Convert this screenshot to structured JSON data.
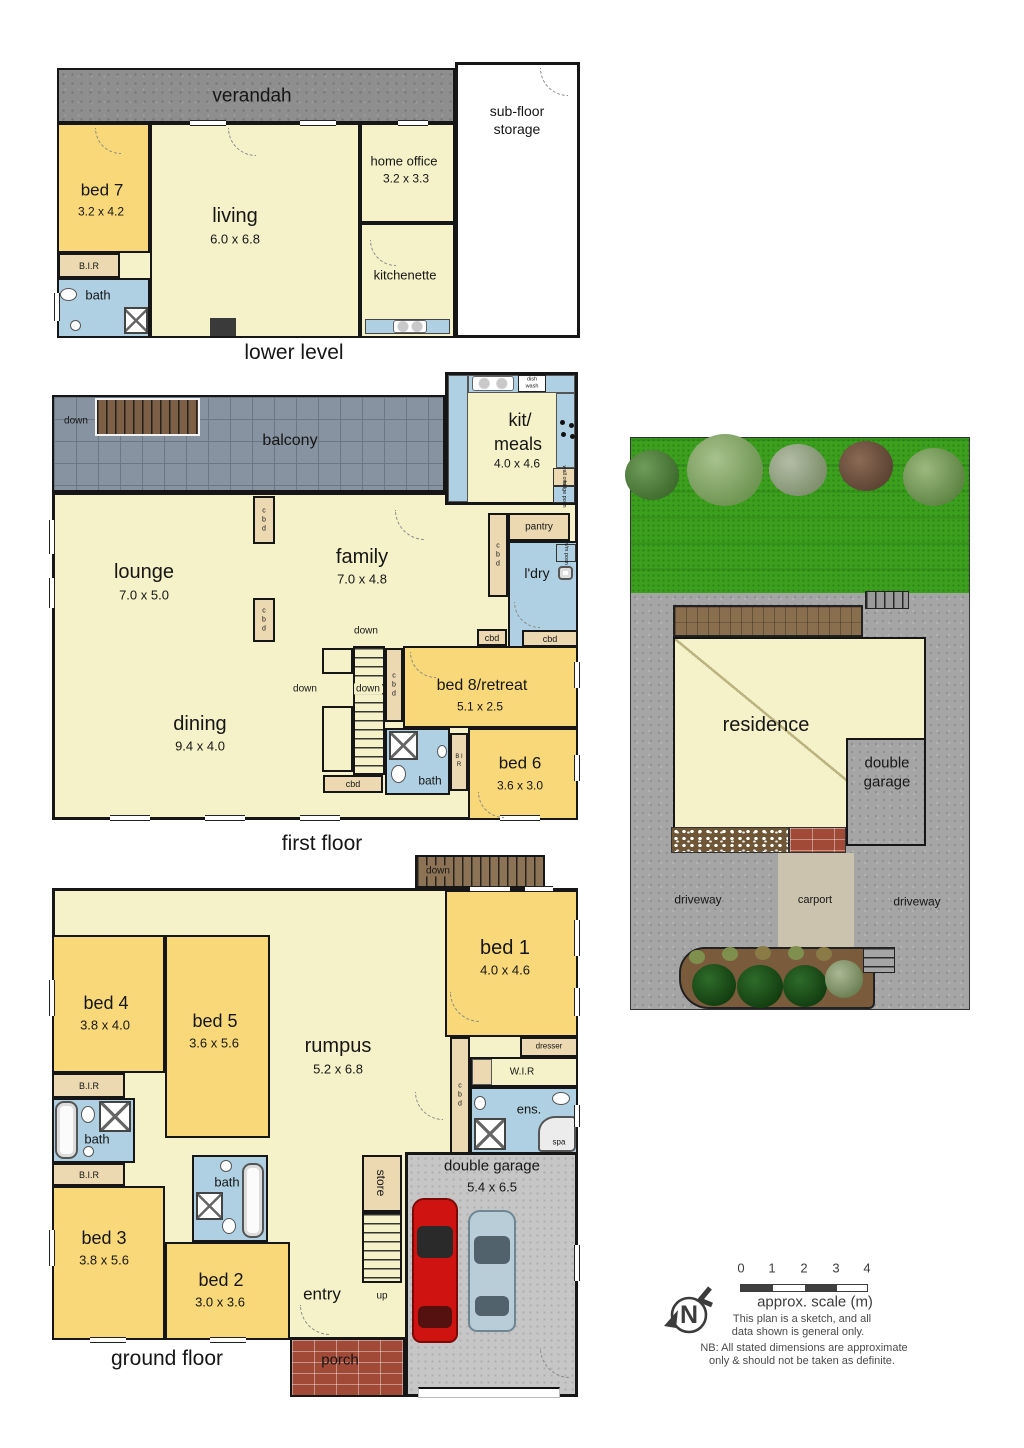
{
  "lower": {
    "title": "lower level",
    "verandah": "verandah",
    "subfloor1": "sub-floor",
    "subfloor2": "storage",
    "bed7": "bed 7",
    "bed7_dims": "3.2 x 4.2",
    "living": "living",
    "living_dims": "6.0 x 6.8",
    "office": "home office",
    "office_dims": "3.2 x 3.3",
    "kitchenette": "kitchenette",
    "bir": "B.I.R",
    "bath": "bath"
  },
  "first": {
    "title": "first floor",
    "balcony": "balcony",
    "down": "down",
    "kit1": "kit/",
    "kit2": "meals",
    "kit_dims": "4.0 x 4.6",
    "dishwash": "dish wash",
    "wall_oven": "wall oven",
    "fridge": "fridge posn",
    "pantry": "pantry",
    "ldry": "l'dry",
    "wm": "w/m posn",
    "lounge": "lounge",
    "lounge_dims": "7.0 x 5.0",
    "family": "family",
    "family_dims": "7.0 x 4.8",
    "dining": "dining",
    "dining_dims": "9.4 x 4.0",
    "bed8": "bed 8/retreat",
    "bed8_dims": "5.1 x 2.5",
    "bed6": "bed 6",
    "bed6_dims": "3.6 x 3.0",
    "bath": "bath",
    "cbd": "cbd",
    "cbd_v": "c b d",
    "bir_v": "B I R"
  },
  "site": {
    "residence": "residence",
    "garage1": "double",
    "garage2": "garage",
    "carport": "carport",
    "driveway": "driveway"
  },
  "ground": {
    "title": "ground floor",
    "balcony": "balcony",
    "up": "up",
    "down": "down",
    "bed1": "bed 1",
    "bed1_dims": "4.0 x 4.6",
    "bed4": "bed 4",
    "bed4_dims": "3.8 x 4.0",
    "bed5": "bed 5",
    "bed5_dims": "3.6 x 5.6",
    "rumpus": "rumpus",
    "rumpus_dims": "5.2 x 6.8",
    "bed3": "bed 3",
    "bed3_dims": "3.8 x 5.6",
    "bed2": "bed 2",
    "bed2_dims": "3.0 x 3.6",
    "garage": "double garage",
    "garage_dims": "5.4 x 6.5",
    "entry": "entry",
    "porch": "porch",
    "store": "store",
    "dresser": "dresser",
    "wir": "W.I.R",
    "ens": "ens.",
    "spa": "spa",
    "bath": "bath",
    "bir": "B.I.R",
    "cbd_v": "c b d"
  },
  "legend": {
    "t0": "0",
    "t1": "1",
    "t2": "2",
    "t3": "3",
    "t4": "4",
    "scale_label": "approx. scale (m)",
    "north": "N",
    "note1": "This plan is a sketch, and all",
    "note2": "data shown is general only.",
    "note3": "NB: All stated dimensions are approximate",
    "note4": "only & should not be taken as definite."
  },
  "colors": {
    "bedroom": "#f8d878",
    "living_area": "#f5f1c8",
    "wet_area": "#aed0e2",
    "cupboard": "#ecd9b2",
    "grass": "#3ca01e",
    "brick": "#a14a38"
  }
}
